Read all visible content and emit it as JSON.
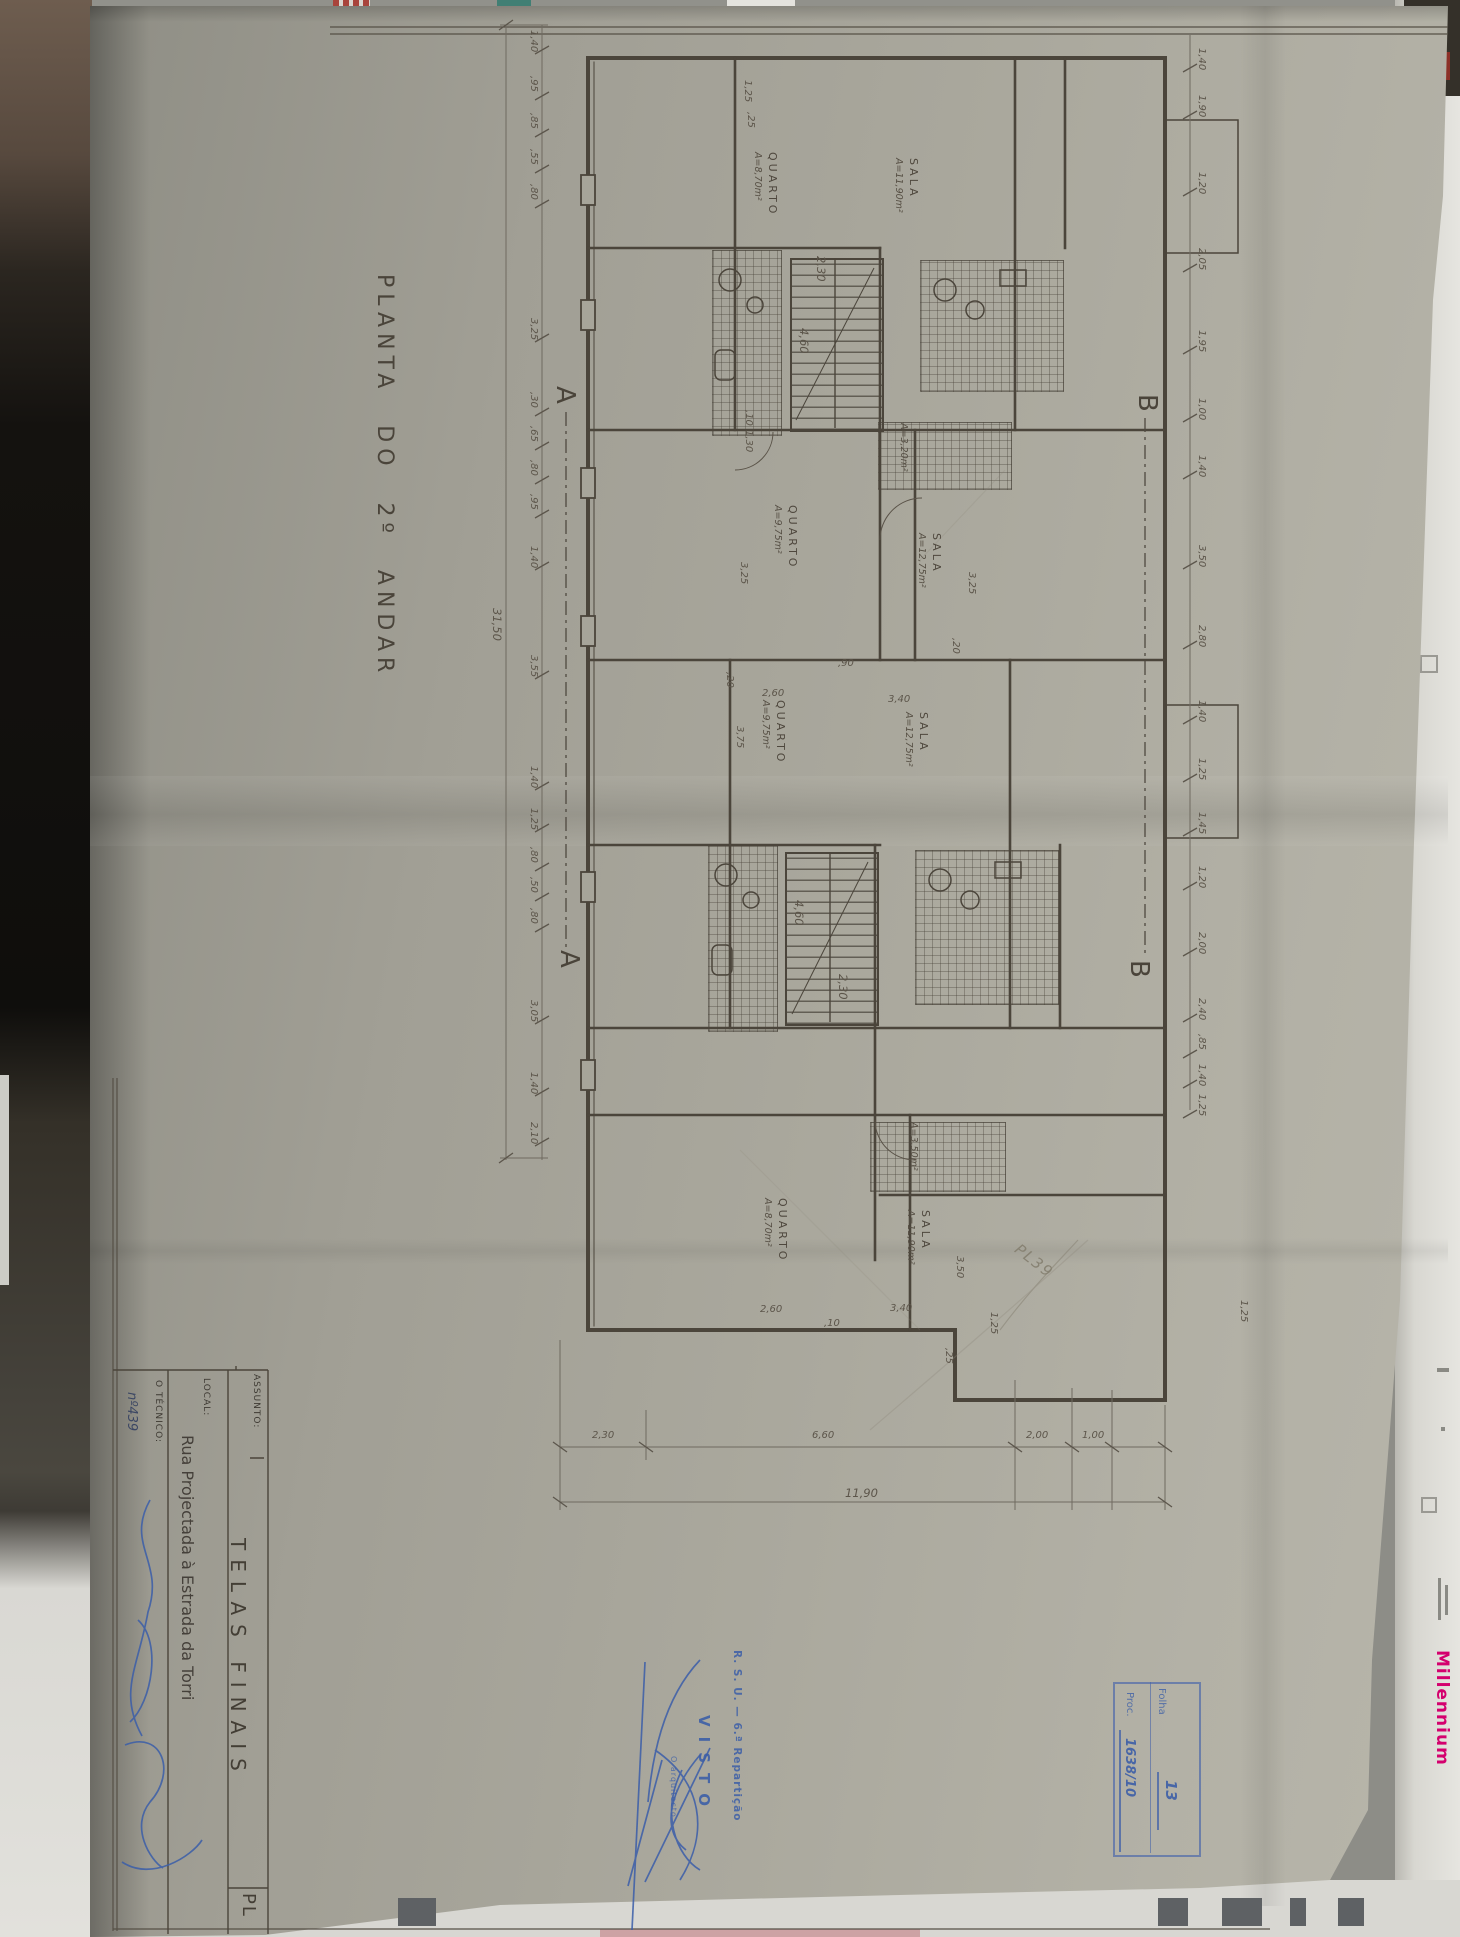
{
  "page": {
    "title": "PLANTA DO 2º ANDAR"
  },
  "title_block": {
    "assunto_label": "ASSUNTO:",
    "assunto_value": "TELAS FINAIS",
    "local_label": "LOCAL:",
    "local_value": "Rua Projectada à Estrada da Torri",
    "tecnico_label": "O TÉCNICO:",
    "tecnico_value": "nº439",
    "corner_code": "PL"
  },
  "stamp": {
    "dept": "R. S. U. — 6.ª Repartição",
    "visto": "VISTO",
    "role": "O arquitecto"
  },
  "archive_box": {
    "folha_label": "Folha",
    "folha_value": "13",
    "proc_label": "Proc.",
    "proc_value": "1638/10"
  },
  "pencil_note": "PL39",
  "background": {
    "millennium": "Millennium",
    "page_number": "2",
    "squares": [
      {
        "x": 398,
        "w": 38
      },
      {
        "x": 1158,
        "w": 30
      },
      {
        "x": 1222,
        "w": 40
      },
      {
        "x": 1290,
        "w": 16
      },
      {
        "x": 1338,
        "w": 26
      }
    ]
  },
  "plan": {
    "markers": [
      {
        "t": "A",
        "x": 550,
        "y": 386
      },
      {
        "t": "A",
        "x": 554,
        "y": 950
      },
      {
        "t": "B",
        "x": 1132,
        "y": 394
      },
      {
        "t": "B",
        "x": 1124,
        "y": 960
      }
    ],
    "rooms": [
      {
        "name": "QUARTO",
        "area": "A=8,70m²",
        "x": 752,
        "y": 152
      },
      {
        "name": "SALA",
        "area": "A=11,90m²",
        "x": 893,
        "y": 158
      },
      {
        "name": "QUARTO",
        "area": "A=9,75m²",
        "x": 772,
        "y": 505
      },
      {
        "name": "SALA",
        "area": "A=12,75m²",
        "x": 916,
        "y": 533
      },
      {
        "name": "QUARTO",
        "area": "A=9,75m²",
        "x": 760,
        "y": 700
      },
      {
        "name": "SALA",
        "area": "A=12,75m²",
        "x": 903,
        "y": 712
      },
      {
        "name": "QUARTO",
        "area": "A=8,70m²",
        "x": 762,
        "y": 1198
      },
      {
        "name": "SALA",
        "area": "A=11,90m²",
        "x": 905,
        "y": 1210
      },
      {
        "name": "",
        "area": "A=3,20m²",
        "x": 898,
        "y": 423
      },
      {
        "name": "",
        "area": "A=3,50m²",
        "x": 908,
        "y": 1122
      }
    ],
    "dims": {
      "left_x": 528,
      "left": [
        {
          "t": "1,40",
          "y": 30
        },
        {
          "t": ",95",
          "y": 76
        },
        {
          "t": ",85",
          "y": 113
        },
        {
          "t": ",55",
          "y": 149
        },
        {
          "t": ",80",
          "y": 184
        },
        {
          "t": "3,25",
          "y": 318
        },
        {
          "t": ",30",
          "y": 392
        },
        {
          "t": ",65",
          "y": 426
        },
        {
          "t": ",80",
          "y": 460
        },
        {
          "t": ",95",
          "y": 494
        },
        {
          "t": "1,40",
          "y": 546
        },
        {
          "t": "3,55",
          "y": 655
        },
        {
          "t": "1,40",
          "y": 766
        },
        {
          "t": "1,25",
          "y": 808
        },
        {
          "t": ",80",
          "y": 847
        },
        {
          "t": ",50",
          "y": 877
        },
        {
          "t": ",80",
          "y": 908
        },
        {
          "t": "3,05",
          "y": 1000
        },
        {
          "t": "1,40",
          "y": 1072
        },
        {
          "t": "2,10",
          "y": 1122
        }
      ],
      "left_total": {
        "t": "31,50",
        "x": 490,
        "y": 608
      },
      "right_x": 1196,
      "right": [
        {
          "t": "1,40",
          "y": 48
        },
        {
          "t": "1,90",
          "y": 95
        },
        {
          "t": "1,20",
          "y": 172
        },
        {
          "t": "2,05",
          "y": 248
        },
        {
          "t": "1,95",
          "y": 330
        },
        {
          "t": "1,00",
          "y": 398
        },
        {
          "t": "1,40",
          "y": 455
        },
        {
          "t": "3,50",
          "y": 545
        },
        {
          "t": "2,80",
          "y": 625
        },
        {
          "t": "1,40",
          "y": 700
        },
        {
          "t": "1,25",
          "y": 758
        },
        {
          "t": "1,45",
          "y": 812
        },
        {
          "t": "1,20",
          "y": 866
        },
        {
          "t": "2,00",
          "y": 932
        },
        {
          "t": "2,40",
          "y": 998
        },
        {
          "t": ",85",
          "y": 1034
        },
        {
          "t": "1,40",
          "y": 1064
        },
        {
          "t": "1,25",
          "y": 1094
        }
      ],
      "right_extra": [
        {
          "t": "1,25",
          "x": 1238,
          "y": 1300
        }
      ],
      "bottom_y": 1430,
      "bottom": [
        {
          "t": "2,30",
          "x": 592
        },
        {
          "t": "6,60",
          "x": 812
        },
        {
          "t": "2,00",
          "x": 1026
        },
        {
          "t": "1,00",
          "x": 1082
        }
      ],
      "bottom_total": {
        "t": "11,90",
        "x": 845,
        "y": 1486
      },
      "interior_v": [
        {
          "t": ",10",
          "x": 743,
          "y": 410
        },
        {
          "t": "1,30",
          "x": 743,
          "y": 430
        },
        {
          "t": "3,25",
          "x": 738,
          "y": 562
        },
        {
          "t": "3,25",
          "x": 966,
          "y": 572
        },
        {
          "t": ",20",
          "x": 950,
          "y": 638
        },
        {
          "t": ",20",
          "x": 724,
          "y": 672
        },
        {
          "t": "2,30",
          "x": 814,
          "y": 256,
          "big": true
        },
        {
          "t": "4,60",
          "x": 797,
          "y": 328,
          "big": true
        },
        {
          "t": "4,60",
          "x": 792,
          "y": 900,
          "big": true
        },
        {
          "t": "2,30",
          "x": 836,
          "y": 974,
          "big": true
        },
        {
          "t": "3,75",
          "x": 734,
          "y": 726
        },
        {
          "t": "3,50",
          "x": 954,
          "y": 1256
        },
        {
          "t": "1,25",
          "x": 988,
          "y": 1312
        },
        {
          "t": ",25",
          "x": 943,
          "y": 1348
        },
        {
          "t": "1,25",
          "x": 742,
          "y": 80
        },
        {
          "t": ",25",
          "x": 745,
          "y": 112
        }
      ],
      "interior_h": [
        {
          "t": "2,60",
          "x": 762,
          "y": 688
        },
        {
          "t": ",90",
          "x": 838,
          "y": 658
        },
        {
          "t": "3,40",
          "x": 888,
          "y": 694
        },
        {
          "t": "2,60",
          "x": 760,
          "y": 1304
        },
        {
          "t": "3,40",
          "x": 890,
          "y": 1303
        },
        {
          "t": ",10",
          "x": 824,
          "y": 1318
        }
      ]
    }
  }
}
